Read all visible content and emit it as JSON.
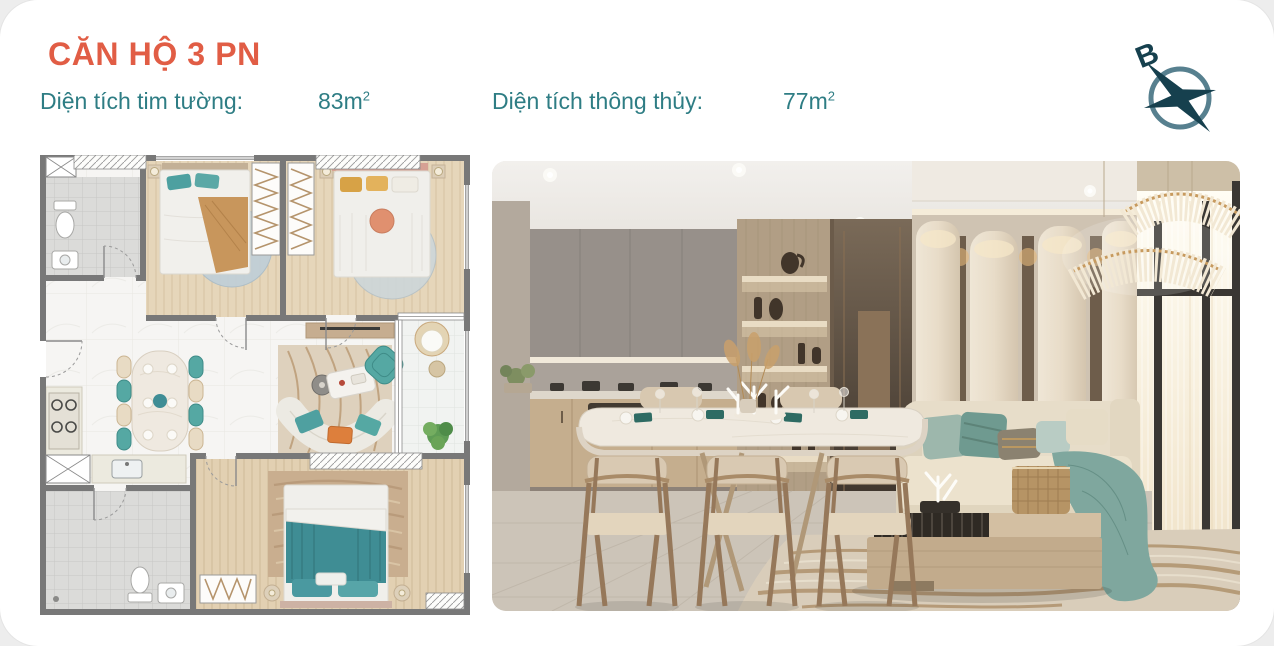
{
  "card": {
    "title": "CĂN HỘ 3 PN"
  },
  "metrics": [
    {
      "label": "Diện tích tim tường:",
      "value": "83m",
      "sup": "2"
    },
    {
      "label": "Diện tích thông thủy:",
      "value": "77m",
      "sup": "2"
    }
  ],
  "compass": {
    "north_label": "B"
  },
  "colors": {
    "accent_orange": "#E15D45",
    "text_teal": "#2E7D84",
    "compass_navy": "#16404E"
  },
  "images": {
    "floor_plan": "3-bedroom apartment floor plan drawing",
    "interior": "Open kitchen, dining and living room interior render"
  }
}
